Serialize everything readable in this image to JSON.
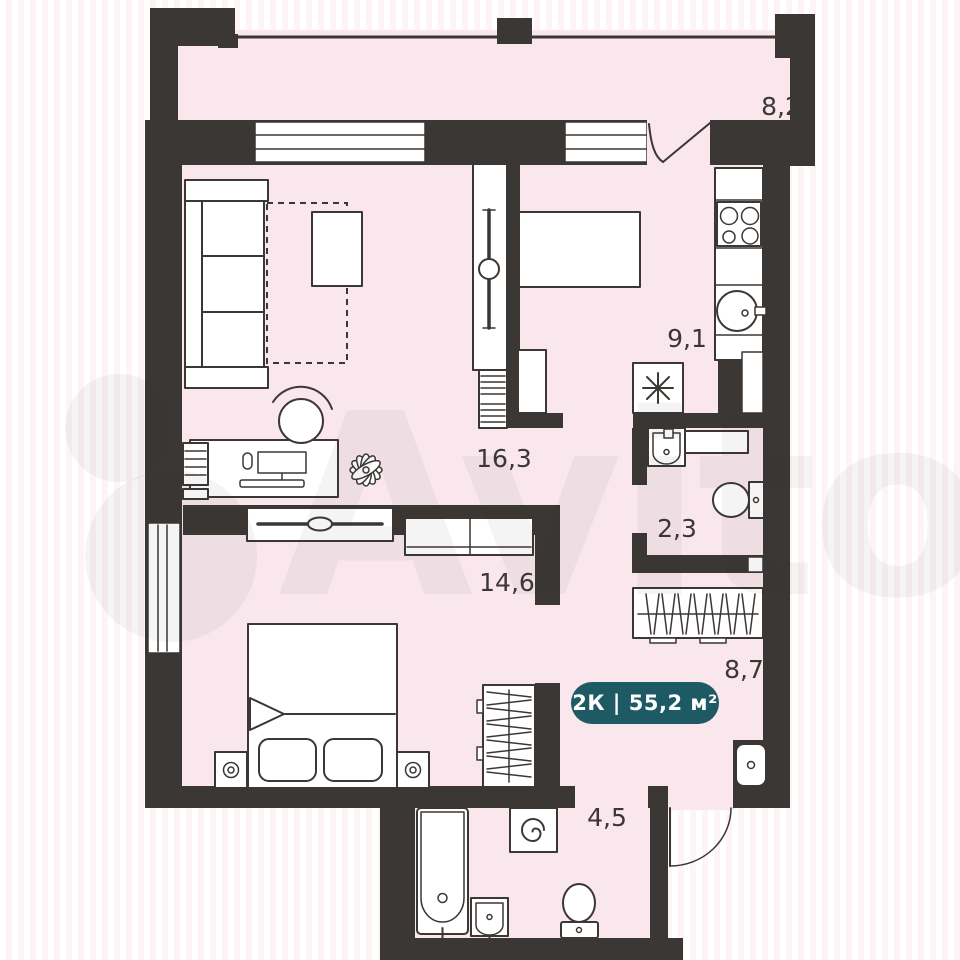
{
  "badge": {
    "label": "2К | 55,2 м²"
  },
  "rooms": [
    {
      "name": "balcony",
      "area_label": "8,2"
    },
    {
      "name": "kitchen",
      "area_label": "9,1"
    },
    {
      "name": "living-room",
      "area_label": "16,3"
    },
    {
      "name": "wc",
      "area_label": "2,3"
    },
    {
      "name": "bedroom",
      "area_label": "14,6"
    },
    {
      "name": "hallway",
      "area_label": "8,7"
    },
    {
      "name": "bathroom",
      "area_label": "4,5"
    }
  ],
  "watermark": {
    "text": "Avito"
  },
  "colors": {
    "wall": "#3B3734",
    "floor": "#F9E7ED",
    "badge_bg": "#1E5A64",
    "badge_text": "#FFFFFF",
    "furniture_outline": "#3B3734",
    "background_stripe": "#FDF4F6"
  }
}
